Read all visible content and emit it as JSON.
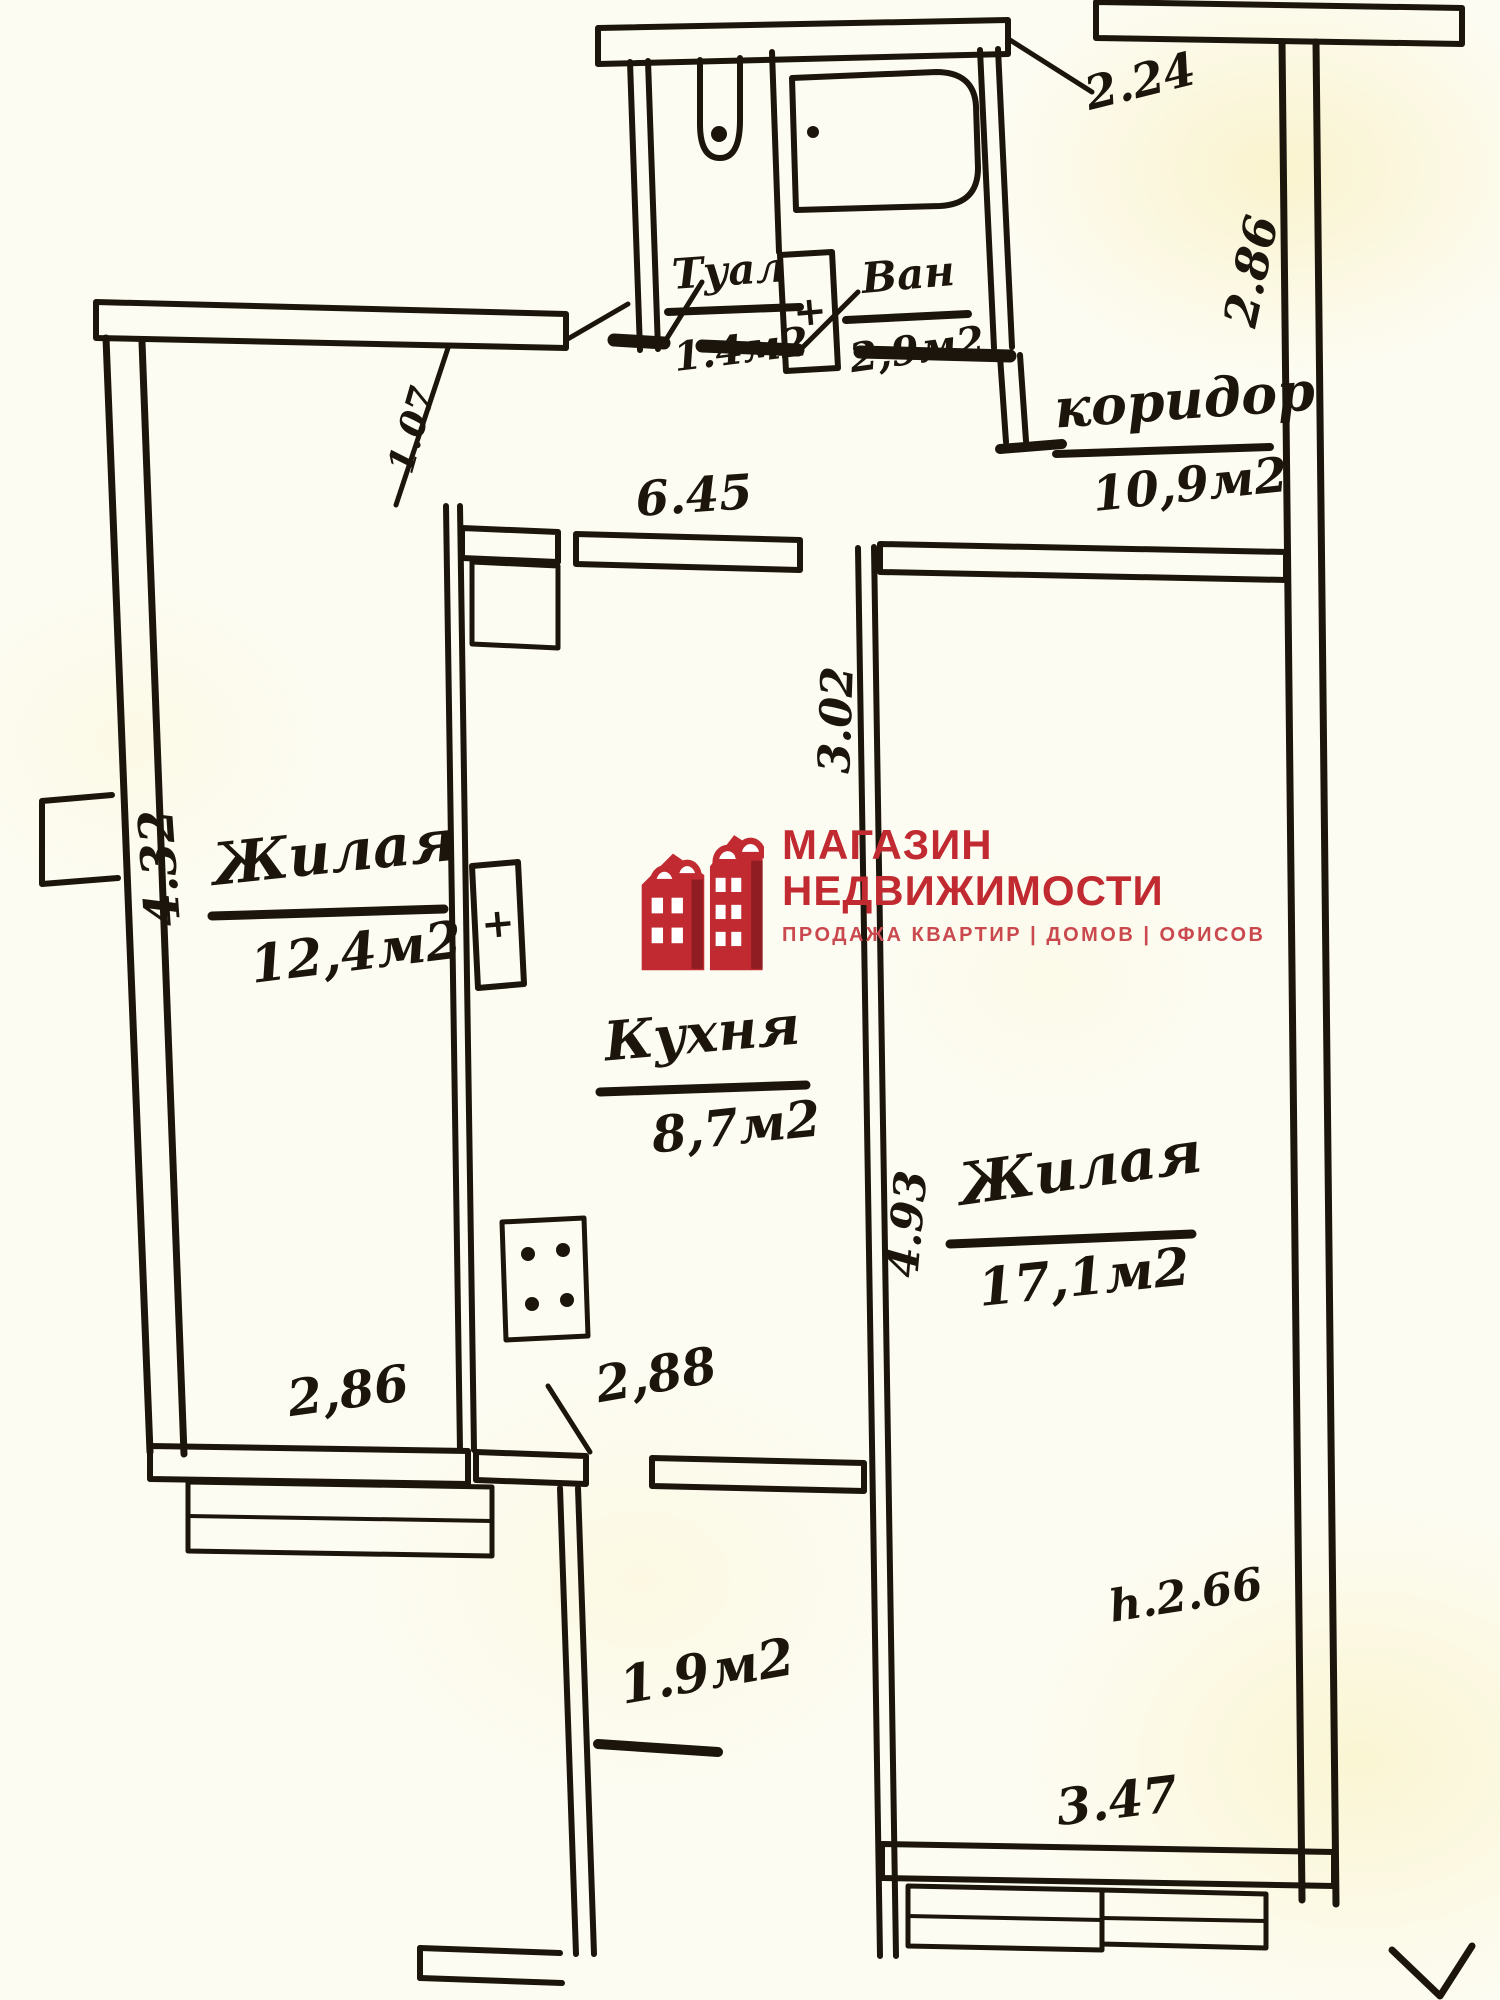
{
  "brand": {
    "line1": "МАГАЗИН",
    "line2": "НЕДВИЖИМОСТИ",
    "tagline": "ПРОДАЖА КВАРТИР | ДОМОВ | ОФИСОВ",
    "red": "#c02a30",
    "red_light": "#c9494e",
    "red_dark": "#8f1d22"
  },
  "rooms": {
    "toilet": {
      "name": "Туал",
      "area": "1.4м2"
    },
    "bath": {
      "name": "Ван",
      "area": "2,9м2"
    },
    "corridor": {
      "name": "коридор",
      "area": "10,9м2"
    },
    "living_left": {
      "name": "Жилая",
      "area": "12,4м2"
    },
    "kitchen": {
      "name": "Кухня",
      "area": "8,7м2"
    },
    "living_right": {
      "name": "Жилая",
      "area": "17,1м2"
    },
    "balcony": {
      "area": "1.9м2"
    }
  },
  "dimensions": {
    "top_width": "2.24",
    "entry_side": "2.86",
    "hall_width": "6.45",
    "door_width": "1.07",
    "living_left_length": "4.32",
    "living_left_width": "2,86",
    "kitchen_width": "2,88",
    "kitchen_length": "3.02",
    "living_right_length": "4.93",
    "living_right_width": "3.47",
    "ceiling_height": "h.2.66"
  },
  "symbols": {
    "vent_cross": "+"
  }
}
